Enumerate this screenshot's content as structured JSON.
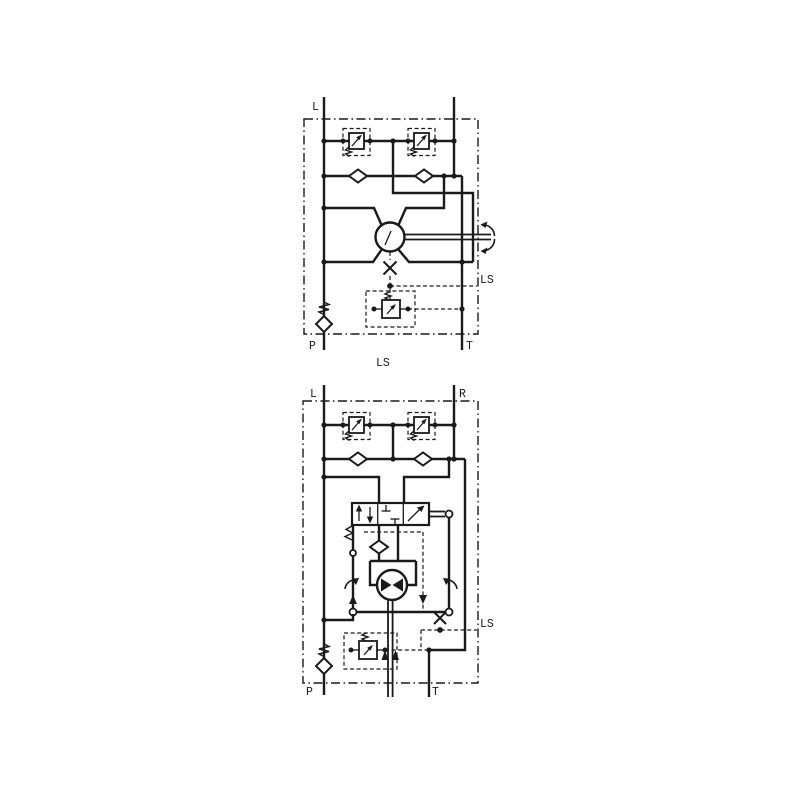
{
  "page": {
    "background": "#ffffff",
    "ink_color": "#1a1a1a",
    "description": "Two hydraulic steering-unit circuit schematics stacked vertically"
  },
  "top_diagram": {
    "port_left": "L",
    "port_pump": "P",
    "port_tank": "T",
    "ls_port": "LS",
    "caption": "LS"
  },
  "bottom_diagram": {
    "port_left": "L",
    "port_right": "R",
    "port_pump": "P",
    "port_tank": "T",
    "ls_port": "LS"
  }
}
